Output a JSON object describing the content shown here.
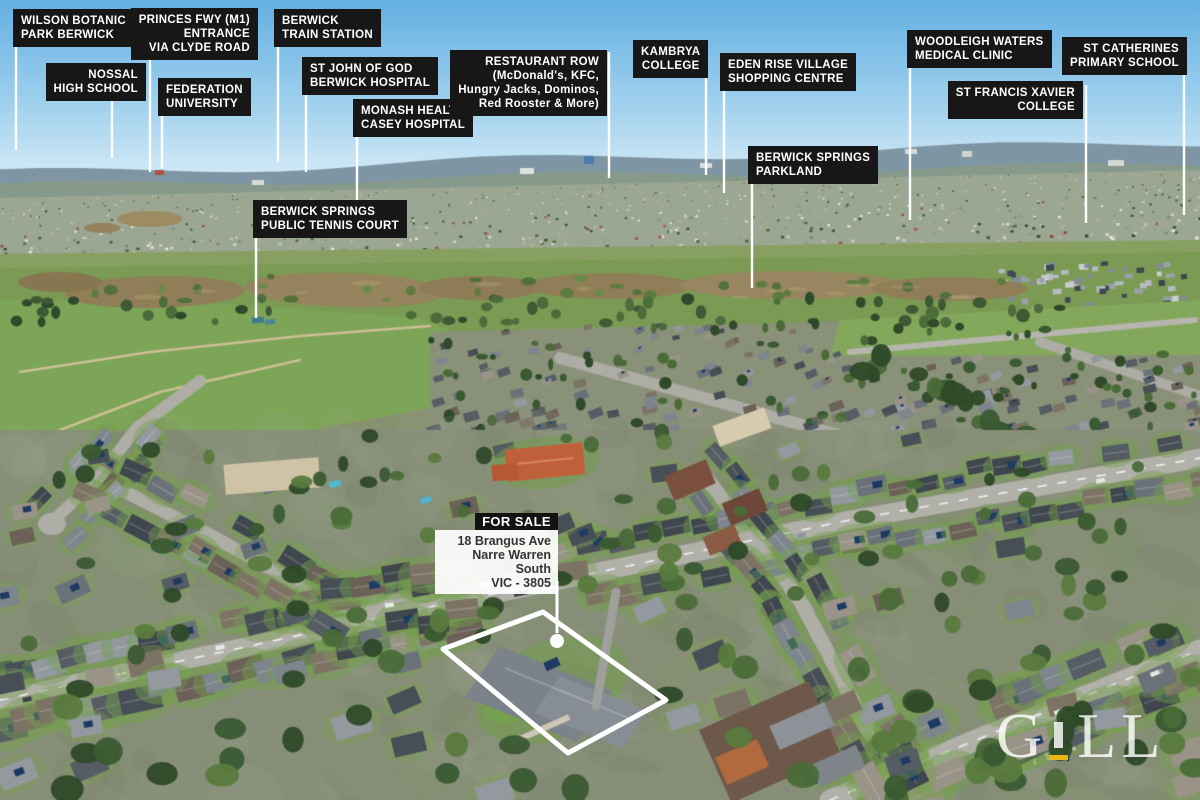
{
  "palette": {
    "sky_top": "#64b0e2",
    "sky_horizon": "#d9edf8",
    "label_bg": "#171717",
    "label_text": "#ffffff",
    "leader_line": "#ffffff",
    "water": "#8f7e57",
    "park_green": "#7b9b54",
    "accent_yellow": "#e9b517",
    "sign_bg": "#121212",
    "sign_text": "#333333"
  },
  "labels": [
    {
      "id": "wilson-botanic-park",
      "lines": [
        "WILSON BOTANIC",
        "PARK BERWICK"
      ],
      "anchor": "left",
      "x": 13,
      "y": 9,
      "align": "left",
      "leader": {
        "x": 16,
        "y1": 47,
        "y2": 150
      }
    },
    {
      "id": "nossal-high-school",
      "lines": [
        "NOSSAL",
        "HIGH SCHOOL"
      ],
      "anchor": "right",
      "x": 146,
      "y": 63,
      "align": "right",
      "leader": {
        "x": 112,
        "y1": 101,
        "y2": 158
      }
    },
    {
      "id": "princes-fwy-entrance",
      "lines": [
        "PRINCES FWY (M1)",
        "ENTRANCE",
        "VIA CLYDE ROAD"
      ],
      "anchor": "right",
      "x": 258,
      "y": 8,
      "align": "right",
      "leader": {
        "x": 150,
        "y1": 56,
        "y2": 172
      }
    },
    {
      "id": "federation-university",
      "lines": [
        "FEDERATION",
        "UNIVERSITY"
      ],
      "anchor": "left",
      "x": 158,
      "y": 78,
      "align": "left",
      "leader": {
        "x": 162,
        "y1": 116,
        "y2": 168
      }
    },
    {
      "id": "berwick-train-station",
      "lines": [
        "BERWICK",
        "TRAIN STATION"
      ],
      "anchor": "left",
      "x": 274,
      "y": 9,
      "align": "left",
      "leader": {
        "x": 278,
        "y1": 47,
        "y2": 162
      }
    },
    {
      "id": "st-john-of-god-hospital",
      "lines": [
        "ST JOHN OF GOD",
        "BERWICK HOSPITAL"
      ],
      "anchor": "left",
      "x": 302,
      "y": 57,
      "align": "left",
      "leader": {
        "x": 306,
        "y1": 95,
        "y2": 172
      }
    },
    {
      "id": "monash-health-casey",
      "lines": [
        "MONASH HEALTH",
        "CASEY HOSPITAL"
      ],
      "anchor": "left",
      "x": 353,
      "y": 99,
      "align": "left",
      "leader": {
        "x": 357,
        "y1": 137,
        "y2": 230
      }
    },
    {
      "id": "restaurant-row",
      "lines": [
        "RESTAURANT ROW",
        "(McDonald's, KFC,",
        "Hungry Jacks, Dominos,",
        "Red Rooster & More)"
      ],
      "anchor": "right",
      "x": 607,
      "y": 50,
      "align": "right",
      "leader": {
        "x": 609,
        "y1": 52,
        "y2": 178
      }
    },
    {
      "id": "kambrya-college",
      "lines": [
        "KAMBRYA",
        "COLLEGE"
      ],
      "anchor": "left",
      "x": 633,
      "y": 40,
      "align": "center",
      "leader": {
        "x": 706,
        "y1": 44,
        "y2": 175
      }
    },
    {
      "id": "eden-rise-village",
      "lines": [
        "EDEN RISE VILLAGE",
        "SHOPPING CENTRE"
      ],
      "anchor": "left",
      "x": 720,
      "y": 53,
      "align": "left",
      "leader": {
        "x": 724,
        "y1": 91,
        "y2": 193
      }
    },
    {
      "id": "berwick-springs-parkland",
      "lines": [
        "BERWICK SPRINGS",
        "PARKLAND"
      ],
      "anchor": "left",
      "x": 748,
      "y": 146,
      "align": "left",
      "leader": {
        "x": 752,
        "y1": 184,
        "y2": 288
      }
    },
    {
      "id": "woodleigh-waters-medical",
      "lines": [
        "WOODLEIGH WATERS",
        "MEDICAL CLINIC"
      ],
      "anchor": "left",
      "x": 907,
      "y": 30,
      "align": "left",
      "leader": {
        "x": 910,
        "y1": 68,
        "y2": 220
      }
    },
    {
      "id": "st-francis-xavier-college",
      "lines": [
        "ST FRANCIS XAVIER",
        "COLLEGE"
      ],
      "anchor": "right",
      "x": 1083,
      "y": 81,
      "align": "right",
      "leader": {
        "x": 1086,
        "y1": 85,
        "y2": 223
      }
    },
    {
      "id": "st-catherines-primary",
      "lines": [
        "ST CATHERINES",
        "PRIMARY SCHOOL"
      ],
      "anchor": "right",
      "x": 1187,
      "y": 37,
      "align": "right",
      "leader": {
        "x": 1184,
        "y1": 75,
        "y2": 215
      }
    },
    {
      "id": "berwick-springs-tennis",
      "lines": [
        "BERWICK SPRINGS",
        "PUBLIC TENNIS COURT"
      ],
      "anchor": "left",
      "x": 253,
      "y": 200,
      "align": "left",
      "leader": {
        "x": 256,
        "y1": 238,
        "y2": 318
      }
    }
  ],
  "sign": {
    "title": "FOR SALE",
    "address_lines": [
      "18 Brangus Ave",
      "Narre Warren South",
      "VIC - 3805"
    ],
    "x": 435,
    "y": 513,
    "width": 123,
    "leader": {
      "x": 557,
      "y1": 581,
      "y2": 633
    },
    "marker": {
      "x": 557,
      "y": 641,
      "r": 7
    }
  },
  "property_outline": {
    "points": [
      [
        543,
        612
      ],
      [
        666,
        700
      ],
      [
        568,
        753
      ],
      [
        443,
        649
      ]
    ]
  },
  "watermark": {
    "letter_g": "G",
    "letters_ll": "LL"
  }
}
